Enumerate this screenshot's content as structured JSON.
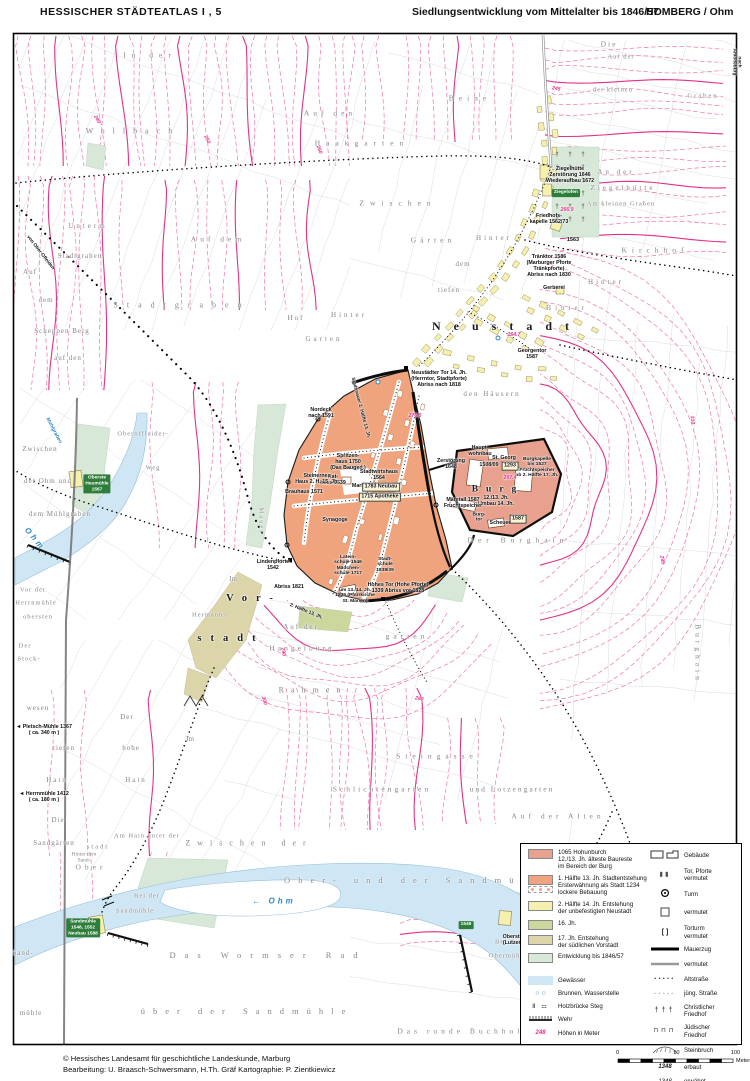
{
  "header": {
    "atlas_title": "HESSISCHER  STÄDTEATLAS   I , 5",
    "map_title": "Siedlungsentwicklung vom Mittelalter bis 1846/57",
    "place": "HOMBERG / Ohm"
  },
  "footer": {
    "copyright": "© Hessisches Landesamt für geschichtliche Landeskunde, Marburg",
    "credits": "Bearbeitung:  U. Braasch-Schwersmann,  H.Th. Gräf    Kartographie:  P. Zientkiewicz"
  },
  "palette": {
    "burg_area": "#e8a18e",
    "altstadt_area": "#efa47d",
    "neustadt_area": "#f6f0ae",
    "jh16_area": "#ccd79e",
    "vorstadt_area": "#dcd5aa",
    "entwicklung_area": "#d7e7d8",
    "water": "#cfe6f4",
    "contour": "#f06aa8",
    "contour_bold": "#e23188",
    "badge_green": "#2e7d3a",
    "water_text": "#2e86c8",
    "elevation_pink": "#e8318a"
  },
  "legend": {
    "areas": [
      {
        "color": "#e8a18e",
        "label": "1065 Hohunburch\n12./13. Jh. älteste Baureste\nim Bereich der Burg"
      },
      {
        "color": "#efa47d",
        "dotted": true,
        "label": "1. Hälfte 13. Jh. Stadtentstehung\nErsterwähnung als Stadt 1234\nlockere Bebauung"
      },
      {
        "color": "#f6f0ae",
        "label": "2. Hälfte 14. Jh. Entstehung\nder unbefestigten Neustadt"
      },
      {
        "color": "#ccd79e",
        "label": "16. Jh."
      },
      {
        "color": "#dcd5aa",
        "label": "17. Jh. Entstehung\nder südlichen Vorstadt"
      },
      {
        "color": "#d7e7d8",
        "label": "Entwicklung bis 1846/57"
      }
    ],
    "water_items": [
      {
        "sym": "water-swatch",
        "label": "Gewässer"
      },
      {
        "sym": "wells",
        "label": "Brunnen, Wasserstelle"
      },
      {
        "sym": "bridge",
        "label": "Holzbrücke   Steg"
      },
      {
        "sym": "wehr",
        "label": "Wehr"
      },
      {
        "sym": "elev",
        "example": "248",
        "label": "Höhen in Meter"
      }
    ],
    "symbol_items": [
      {
        "sym": "buildings",
        "label": "Gebäude"
      },
      {
        "sym": "gate",
        "label": "Tor, Pforte\nvermutet"
      },
      {
        "sym": "tower",
        "label": "Turm"
      },
      {
        "sym": "square",
        "label": "vermutet"
      },
      {
        "sym": "brackets",
        "label": "Torturm\nvermutet"
      },
      {
        "sym": "wall",
        "label": "Mauerzug"
      },
      {
        "sym": "wall-gray",
        "label": "vermutet"
      },
      {
        "sym": "dots-filled",
        "label": "Altstraße"
      },
      {
        "sym": "dots-open",
        "label": "jüng. Straße"
      },
      {
        "sym": "crosses",
        "label": "Christlicher\nFriedhof"
      },
      {
        "sym": "jewish",
        "label": "Jüdischer\nFriedhof"
      },
      {
        "sym": "quarry",
        "label": "Steinbruch"
      },
      {
        "sym": "year-bold",
        "example": "1348",
        "label": "erbaut"
      },
      {
        "sym": "year-italic",
        "example": "1348",
        "label": "erwähnt"
      }
    ]
  },
  "scalebar": {
    "labels": [
      "0",
      "50",
      "100"
    ],
    "unit": "Meter"
  },
  "map": {
    "labels": [
      {
        "t": "In der",
        "x": 150,
        "y": 56,
        "ls": 6
      },
      {
        "t": "Wollbach",
        "x": 133,
        "y": 131,
        "ls": 8,
        "fs": 8
      },
      {
        "t": "Auf den",
        "x": 330,
        "y": 114,
        "ls": 4
      },
      {
        "t": "Haakgarten",
        "x": 362,
        "y": 144,
        "ls": 6
      },
      {
        "t": "Die",
        "x": 609,
        "y": 45,
        "ls": 2
      },
      {
        "t": "Auf der",
        "x": 621,
        "y": 57,
        "ls": 1,
        "fs": 6.5
      },
      {
        "t": "Beine",
        "x": 470,
        "y": 99,
        "ls": 5
      },
      {
        "t": "der kleinen",
        "x": 613,
        "y": 90,
        "ls": 1,
        "fs": 6.5
      },
      {
        "t": "Graben",
        "x": 703,
        "y": 96,
        "ls": 2,
        "fs": 6.5
      },
      {
        "t": "Zwischen",
        "x": 398,
        "y": 204,
        "ls": 6
      },
      {
        "t": "Auf dem",
        "x": 218,
        "y": 240,
        "ls": 4
      },
      {
        "t": "Gärten",
        "x": 433,
        "y": 241,
        "ls": 4
      },
      {
        "t": "Unterm",
        "x": 88,
        "y": 226,
        "ls": 3,
        "fs": 7
      },
      {
        "t": "Stadtgraben",
        "x": 80,
        "y": 256,
        "ls": 1,
        "fs": 7
      },
      {
        "t": "Auf",
        "x": 30,
        "y": 272,
        "ls": 1,
        "fs": 7
      },
      {
        "t": "dem",
        "x": 46,
        "y": 300,
        "ls": 1,
        "fs": 7
      },
      {
        "t": "Scheppen Berg",
        "x": 62,
        "y": 331,
        "ls": 1,
        "fs": 7
      },
      {
        "t": "auf den",
        "x": 68,
        "y": 358,
        "ls": 1,
        "fs": 7
      },
      {
        "t": "Stadtgraben",
        "x": 182,
        "y": 305,
        "ls": 9,
        "fs": 8
      },
      {
        "t": "Hof",
        "x": 296,
        "y": 318,
        "ls": 2,
        "fs": 7
      },
      {
        "t": "Hinter",
        "x": 349,
        "y": 315,
        "ls": 3,
        "fs": 7
      },
      {
        "t": "Garten",
        "x": 324,
        "y": 339,
        "ls": 3,
        "fs": 7
      },
      {
        "t": "An der",
        "x": 616,
        "y": 172,
        "ls": 3,
        "fs": 7
      },
      {
        "t": "Ziegelhütte",
        "x": 623,
        "y": 188,
        "ls": 3,
        "fs": 7
      },
      {
        "t": "Am kleinen Graben",
        "x": 621,
        "y": 204,
        "ls": 1,
        "fs": 6.5
      },
      {
        "t": "Kirchhof",
        "x": 655,
        "y": 251,
        "ls": 5
      },
      {
        "t": "Hinter",
        "x": 494,
        "y": 238,
        "ls": 3,
        "fs": 7
      },
      {
        "t": "dem",
        "x": 463,
        "y": 264,
        "ls": 1,
        "fs": 7
      },
      {
        "t": "tiefen",
        "x": 449,
        "y": 290,
        "ls": 1,
        "fs": 7
      },
      {
        "t": "Hinter",
        "x": 606,
        "y": 282,
        "ls": 3,
        "fs": 7
      },
      {
        "t": "Hinter",
        "x": 567,
        "y": 308,
        "ls": 4,
        "fs": 7
      },
      {
        "t": "den Häusern",
        "x": 492,
        "y": 394,
        "ls": 2,
        "fs": 7
      },
      {
        "t": "Mauer",
        "x": 261,
        "y": 521,
        "r": 90,
        "ls": 2,
        "fs": 6.5
      },
      {
        "t": "Der Burghain",
        "x": 518,
        "y": 541,
        "ls": 5
      },
      {
        "t": "Burghain",
        "x": 697,
        "y": 654,
        "r": 90,
        "ls": 4
      },
      {
        "t": "wesen",
        "x": 38,
        "y": 708,
        "ls": 1,
        "fs": 7
      },
      {
        "t": "tiefen",
        "x": 64,
        "y": 748,
        "ls": 1,
        "fs": 7
      },
      {
        "t": "Hain",
        "x": 57,
        "y": 780,
        "ls": 2,
        "fs": 7
      },
      {
        "t": "Der",
        "x": 127,
        "y": 717,
        "ls": 1,
        "fs": 7
      },
      {
        "t": "hohe",
        "x": 131,
        "y": 748,
        "ls": 1,
        "fs": 7
      },
      {
        "t": "Hain",
        "x": 136,
        "y": 780,
        "ls": 2,
        "fs": 7
      },
      {
        "t": "Die",
        "x": 58,
        "y": 820,
        "ls": 1,
        "fs": 7
      },
      {
        "t": "Sandgärten",
        "x": 54,
        "y": 843,
        "ls": 1,
        "fs": 7
      },
      {
        "t": "Im",
        "x": 233,
        "y": 579,
        "ls": 0,
        "fs": 7
      },
      {
        "t": "Im",
        "x": 190,
        "y": 739,
        "ls": 0,
        "fs": 7
      },
      {
        "t": "Steingasse",
        "x": 437,
        "y": 757,
        "ls": 5
      },
      {
        "t": "Rahmen",
        "x": 313,
        "y": 690,
        "ls": 7,
        "fs": 8
      },
      {
        "t": "Auf der",
        "x": 301,
        "y": 627,
        "ls": 2,
        "fs": 7
      },
      {
        "t": "Hangelburg",
        "x": 302,
        "y": 649,
        "ls": 3
      },
      {
        "t": "garten",
        "x": 407,
        "y": 637,
        "ls": 4
      },
      {
        "t": "Schlichtengarten",
        "x": 382,
        "y": 790,
        "ls": 3
      },
      {
        "t": "und Lotzengarten",
        "x": 512,
        "y": 790,
        "ls": 2
      },
      {
        "t": "Auf der Alten",
        "x": 558,
        "y": 817,
        "ls": 4
      },
      {
        "t": "Zwischen der",
        "x": 249,
        "y": 843,
        "ls": 7,
        "fs": 8
      },
      {
        "t": "Am Hain unter der",
        "x": 147,
        "y": 836,
        "ls": 1,
        "fs": 6.5
      },
      {
        "t": "stadt",
        "x": 98,
        "y": 847,
        "ls": 2,
        "fs": 6.5
      },
      {
        "t": "Hinter dem\nSand-",
        "x": 84,
        "y": 858,
        "ls": 0,
        "fs": 5.5
      },
      {
        "t": "Ober",
        "x": 91,
        "y": 868,
        "ls": 4
      },
      {
        "t": "Bei der",
        "x": 147,
        "y": 896,
        "ls": 1,
        "fs": 6.5
      },
      {
        "t": "Sandmühle",
        "x": 135,
        "y": 911,
        "ls": 1,
        "fs": 6.5
      },
      {
        "t": "Ober- und der Sandmühle",
        "x": 420,
        "y": 881,
        "ls": 8,
        "fs": 8.5
      },
      {
        "t": "Das Wormser Rad",
        "x": 268,
        "y": 956,
        "ls": 9,
        "fs": 8.5
      },
      {
        "t": "über der Sandmühle",
        "x": 247,
        "y": 1012,
        "ls": 8,
        "fs": 8.5
      },
      {
        "t": "Das runde Buchholz",
        "x": 464,
        "y": 1032,
        "ls": 4
      },
      {
        "t": "Bei der",
        "x": 508,
        "y": 942,
        "ls": 1,
        "fs": 6.5
      },
      {
        "t": "Obermühle",
        "x": 508,
        "y": 956,
        "ls": 1,
        "fs": 6.5
      },
      {
        "t": "Sand-",
        "x": 23,
        "y": 953,
        "ls": 1,
        "fs": 7
      },
      {
        "t": "mühle",
        "x": 31,
        "y": 1013,
        "ls": 1,
        "fs": 7
      },
      {
        "t": "Oberoffleider-",
        "x": 143,
        "y": 434,
        "ls": 1,
        "fs": 6.5
      },
      {
        "t": "Weg",
        "x": 153,
        "y": 468,
        "ls": 1,
        "fs": 6.5
      },
      {
        "t": "Zwischen",
        "x": 40,
        "y": 449,
        "ls": 1,
        "fs": 7
      },
      {
        "t": "der Ohm und",
        "x": 48,
        "y": 481,
        "ls": 1,
        "fs": 7
      },
      {
        "t": "dem Mühlgraben",
        "x": 60,
        "y": 514,
        "ls": 1,
        "fs": 7
      },
      {
        "t": "Vor der",
        "x": 33,
        "y": 590,
        "ls": 1,
        "fs": 6.5
      },
      {
        "t": "Herrnmühle",
        "x": 36,
        "y": 603,
        "ls": 1,
        "fs": 6.5
      },
      {
        "t": "obersten",
        "x": 38,
        "y": 617,
        "ls": 1,
        "fs": 6.5
      },
      {
        "t": "Der",
        "x": 25,
        "y": 646,
        "ls": 1,
        "fs": 6.5
      },
      {
        "t": "Stock-",
        "x": 29,
        "y": 659,
        "ls": 1,
        "fs": 6.5
      },
      {
        "t": "Hermanns-",
        "x": 211,
        "y": 615,
        "ls": 1,
        "fs": 6.5
      },
      {
        "t": "Neustadt",
        "x": 507,
        "y": 327,
        "s": "bk",
        "fs": 12,
        "ls": 13
      },
      {
        "t": "Burg",
        "x": 498,
        "y": 490,
        "s": "bk",
        "fs": 9.5,
        "ls": 8
      },
      {
        "t": "Vor-",
        "x": 254,
        "y": 599,
        "s": "bk",
        "fs": 10.5,
        "ls": 9
      },
      {
        "t": "stadt",
        "x": 231,
        "y": 639,
        "s": "bk",
        "fs": 10.5,
        "ls": 9
      },
      {
        "t": "Ziegelhütte\nZerstörung 1646\nWiederaufbau 1672",
        "x": 570,
        "y": 176,
        "s": "i"
      },
      {
        "t": "Ziegelofen",
        "x": 566,
        "y": 193,
        "s": "bdg"
      },
      {
        "t": "Friedhofs-\nkapelle 1562/73",
        "x": 549,
        "y": 220,
        "s": "i"
      },
      {
        "t": "1563",
        "x": 573,
        "y": 240,
        "s": "i",
        "fs": 5.5
      },
      {
        "t": "Tränktor 1586\n(Marburger Pforte\nTränkpforte)\nAbriss nach 1830",
        "x": 549,
        "y": 267,
        "s": "i"
      },
      {
        "t": "Gerberei",
        "x": 554,
        "y": 289,
        "s": "i"
      },
      {
        "t": "Georgentor\n1587",
        "x": 532,
        "y": 355,
        "s": "i"
      },
      {
        "t": "Neustädter Tor 14. Jh.\n(Herrntor, Stadtpforte)\nAbriss nach 1818",
        "x": 439,
        "y": 380,
        "s": "i"
      },
      {
        "t": "Nordeck\nnach 1591",
        "x": 321,
        "y": 414,
        "s": "i"
      },
      {
        "t": "Spritzen-\nhaus 1750\n(Das Bauged.)",
        "x": 348,
        "y": 463,
        "s": "i"
      },
      {
        "t": "Rat-\nhaus 1539",
        "x": 333,
        "y": 481,
        "s": "i"
      },
      {
        "t": "Markt",
        "x": 359,
        "y": 487,
        "s": "i"
      },
      {
        "t": "Stadtwirtshaus\n1564",
        "x": 379,
        "y": 476,
        "s": "i"
      },
      {
        "t": "1783 Neubau",
        "x": 381,
        "y": 487,
        "s": "bx"
      },
      {
        "t": "1715 Apotheke",
        "x": 380,
        "y": 497,
        "s": "bx"
      },
      {
        "t": "Steinernes\nHaus 2. H. 15. Jh.",
        "x": 317,
        "y": 480,
        "s": "i"
      },
      {
        "t": "Brauhaus 1571",
        "x": 304,
        "y": 493,
        "s": "i"
      },
      {
        "t": "Synagoge",
        "x": 335,
        "y": 521,
        "s": "i"
      },
      {
        "t": "Zerstörung\n1648",
        "x": 451,
        "y": 465,
        "s": "i"
      },
      {
        "t": "Haupt-\nwohnbau",
        "x": 480,
        "y": 452,
        "s": "i"
      },
      {
        "t": "St. Georg",
        "x": 504,
        "y": 459,
        "s": "i"
      },
      {
        "t": "1508/09",
        "x": 489,
        "y": 466,
        "s": "i"
      },
      {
        "t": "1293",
        "x": 510,
        "y": 466,
        "s": "bx"
      },
      {
        "t": "Burgkapelle\nbis 1527\nFruchtspeicher\nab 2. Hälfte 17. Jh.",
        "x": 537,
        "y": 468,
        "s": "i",
        "fs": 4.9
      },
      {
        "t": "12./13. Jh.\nUmbau 14. Jh.",
        "x": 496,
        "y": 502,
        "s": "i"
      },
      {
        "t": "Marstall 1587\nFruchtspeicher",
        "x": 463,
        "y": 504,
        "s": "i"
      },
      {
        "t": "Burg-\ntor",
        "x": 479,
        "y": 518,
        "s": "i",
        "fs": 4.9
      },
      {
        "t": "Scheuer",
        "x": 500,
        "y": 524,
        "s": "i"
      },
      {
        "t": "1587",
        "x": 518,
        "y": 519,
        "s": "bx"
      },
      {
        "t": "Lindenpforte\n1542",
        "x": 273,
        "y": 566,
        "s": "i"
      },
      {
        "t": "Abriss 1821",
        "x": 289,
        "y": 588,
        "s": "i"
      },
      {
        "t": "Latein-\nschule 1546\nMädchen-\nschule 1717",
        "x": 348,
        "y": 566,
        "s": "i",
        "fs": 4.9
      },
      {
        "t": "Stadt-\nschule\n1838/39",
        "x": 385,
        "y": 565,
        "s": "i",
        "fs": 4.9
      },
      {
        "t": "um 13./14. Jh.\n1239 (Pfarrkirche\nSt. Marien)",
        "x": 355,
        "y": 596,
        "s": "i",
        "fs": 4.9
      },
      {
        "t": "Hohes Tor (Hohe Pforte)\n1339  Abriss vor 1828",
        "x": 398,
        "y": 589,
        "s": "i"
      },
      {
        "t": "Stadtmauer 2. Hälfte 13. Jh.",
        "x": 360,
        "y": 408,
        "s": "i",
        "r": 75,
        "fs": 4.8
      },
      {
        "t": "2. Hälfte 13. Jh.",
        "x": 306,
        "y": 612,
        "s": "i",
        "r": 22,
        "fs": 4.8
      },
      {
        "t": "◄ Pletsch-Mühle 1367\n( ca. 340 m )",
        "x": 44,
        "y": 731,
        "s": "i"
      },
      {
        "t": "◄ Herrnmühle 1412\n( ca. 180 m )",
        "x": 44,
        "y": 798,
        "s": "i"
      },
      {
        "t": "Oberste Mühle\n(Lutzenmühle)",
        "x": 521,
        "y": 941,
        "s": "i"
      },
      {
        "t": "von Ober-Ofleiden",
        "x": 40,
        "y": 253,
        "s": "i",
        "r": 52,
        "fs": 4.8
      },
      {
        "t": "nach Amöneburg",
        "x": 736,
        "y": 62,
        "s": "i",
        "r": 90,
        "fs": 4.8
      },
      {
        "t": "Oberste\nHeumühle\n1567",
        "x": 97,
        "y": 484,
        "s": "bdg"
      },
      {
        "t": "Sandmühle\n1548, 1552\nNeubau 1588",
        "x": 83,
        "y": 928,
        "s": "bdg"
      },
      {
        "t": "1549",
        "x": 466,
        "y": 925,
        "s": "bdg"
      },
      {
        "t": "Ohm",
        "x": 35,
        "y": 539,
        "s": "w",
        "r": 50,
        "ls": 3,
        "fs": 8
      },
      {
        "t": "← Ohm",
        "x": 274,
        "y": 901,
        "s": "w",
        "ls": 3,
        "fs": 8
      },
      {
        "t": "Mühlgraben",
        "x": 53,
        "y": 431,
        "s": "w",
        "r": 62,
        "fs": 5
      },
      {
        "t": "266.9",
        "x": 567,
        "y": 211,
        "s": "e"
      },
      {
        "t": "264.7",
        "x": 514,
        "y": 336,
        "s": "e"
      },
      {
        "t": "276.5",
        "x": 415,
        "y": 417,
        "s": "e"
      },
      {
        "t": "267.4",
        "x": 510,
        "y": 479,
        "s": "e"
      },
      {
        "t": "290",
        "x": 282,
        "y": 652,
        "s": "e",
        "r": 80
      },
      {
        "t": "300",
        "x": 263,
        "y": 701,
        "s": "e",
        "r": 75
      },
      {
        "t": "280",
        "x": 419,
        "y": 700,
        "s": "e",
        "r": 10
      },
      {
        "t": "240",
        "x": 96,
        "y": 120,
        "s": "e",
        "r": 60
      },
      {
        "t": "250",
        "x": 206,
        "y": 140,
        "s": "e",
        "r": 65
      },
      {
        "t": "260",
        "x": 318,
        "y": 150,
        "s": "e",
        "r": 70
      },
      {
        "t": "310",
        "x": 691,
        "y": 420,
        "s": "e",
        "r": 85
      },
      {
        "t": "295",
        "x": 661,
        "y": 560,
        "s": "e",
        "r": 80
      },
      {
        "t": "245",
        "x": 556,
        "y": 90,
        "s": "e",
        "r": 10
      }
    ]
  }
}
